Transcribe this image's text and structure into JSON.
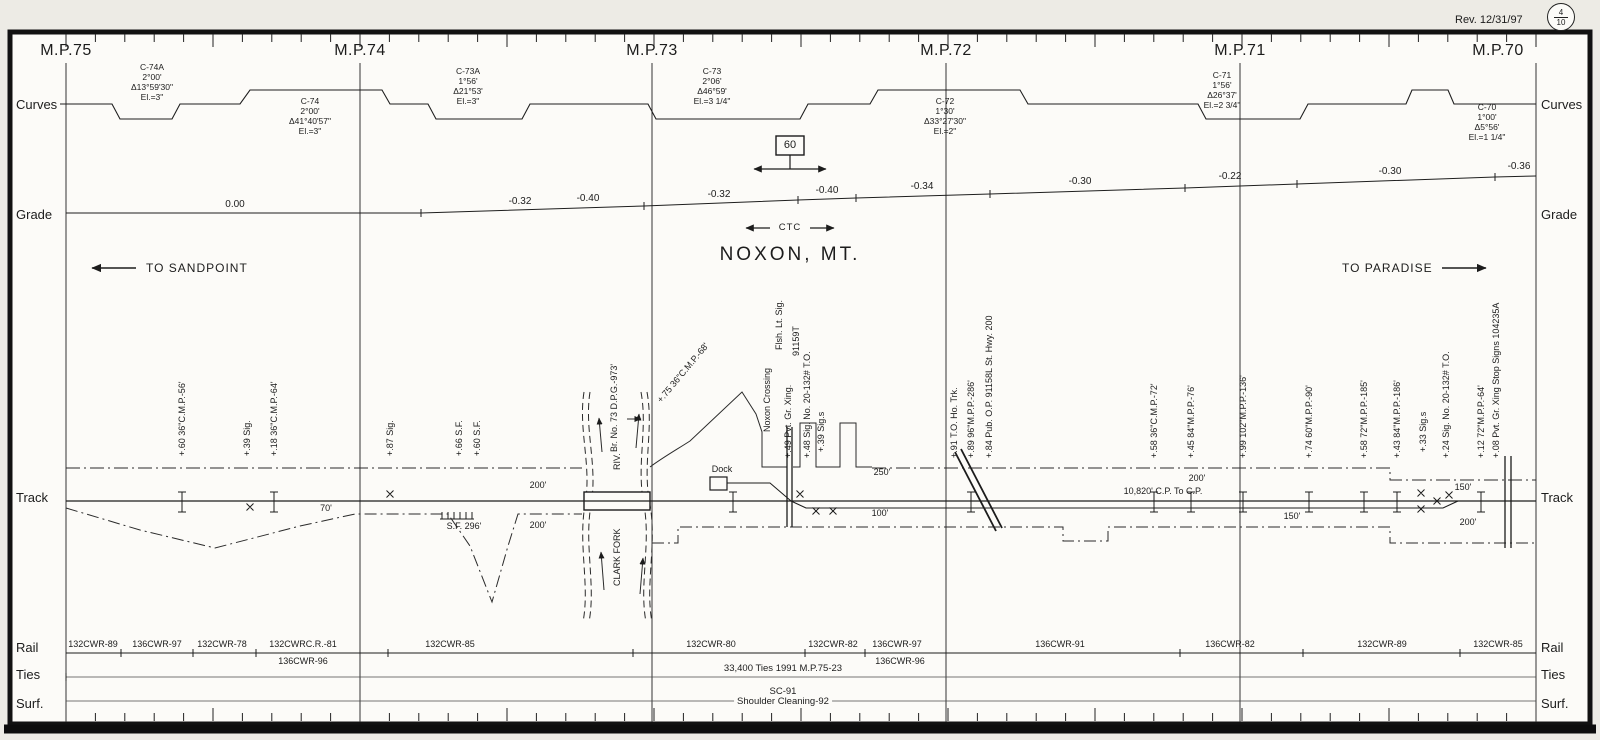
{
  "meta": {
    "rev": "Rev. 12/31/97",
    "sheet_num": "4",
    "sheet_total": "10"
  },
  "title": {
    "station": "NOXON, MT.",
    "ctc": "CTC",
    "speed": "60",
    "to_left": "TO SANDPOINT",
    "to_right": "TO PARADISE"
  },
  "gutter": {
    "rows": [
      {
        "t": "Curves",
        "y": 97
      },
      {
        "t": "Grade",
        "y": 207
      },
      {
        "t": "Track",
        "y": 490
      },
      {
        "t": "Rail",
        "y": 640
      },
      {
        "t": "Ties",
        "y": 667
      },
      {
        "t": "Surf.",
        "y": 696
      }
    ]
  },
  "mileposts": [
    {
      "label": "M.P.75",
      "label_x": 66,
      "line_x": 66
    },
    {
      "label": "M.P.74",
      "label_x": 360,
      "line_x": 360
    },
    {
      "label": "M.P.73",
      "label_x": 652,
      "line_x": 652
    },
    {
      "label": "M.P.72",
      "label_x": 946,
      "line_x": 946
    },
    {
      "label": "M.P.71",
      "label_x": 1240,
      "line_x": 1240
    },
    {
      "label": "M.P.70",
      "label_x": 1498,
      "line_x": 1536
    }
  ],
  "curves": [
    {
      "name": "C-74A",
      "deg": "2°00'",
      "delta": "Δ13°59'30\"",
      "el": "El.=3\"",
      "cx": 152,
      "top": 62
    },
    {
      "name": "C-74",
      "deg": "2°00'",
      "delta": "Δ41°40'57\"",
      "el": "El.=3\"",
      "cx": 310,
      "top": 96
    },
    {
      "name": "C-73A",
      "deg": "1°56'",
      "delta": "Δ21°53'",
      "el": "El.=3\"",
      "cx": 468,
      "top": 66
    },
    {
      "name": "C-73",
      "deg": "2°06'",
      "delta": "Δ46°59'",
      "el": "El.=3 1/4\"",
      "cx": 712,
      "top": 66
    },
    {
      "name": "C-72",
      "deg": "1°30'",
      "delta": "Δ33°27'30\"",
      "el": "El.=2\"",
      "cx": 945,
      "top": 96
    },
    {
      "name": "C-71",
      "deg": "1°56'",
      "delta": "Δ26°37'",
      "el": "El.=2 3/4\"",
      "cx": 1222,
      "top": 70
    },
    {
      "name": "C-70",
      "deg": "1°00'",
      "delta": "Δ5°56'",
      "el": "El.=1 1/4\"",
      "cx": 1487,
      "top": 102
    }
  ],
  "grade": {
    "values": [
      {
        "v": "0.00",
        "x": 235,
        "y": 199
      },
      {
        "v": "-0.32",
        "x": 520,
        "y": 196
      },
      {
        "v": "-0.40",
        "x": 588,
        "y": 193
      },
      {
        "v": "-0.32",
        "x": 719,
        "y": 189
      },
      {
        "v": "-0.40",
        "x": 827,
        "y": 185
      },
      {
        "v": "-0.34",
        "x": 922,
        "y": 181
      },
      {
        "v": "-0.30",
        "x": 1080,
        "y": 176
      },
      {
        "v": "-0.22",
        "x": 1230,
        "y": 171
      },
      {
        "v": "-0.30",
        "x": 1390,
        "y": 166
      },
      {
        "v": "-0.36",
        "x": 1519,
        "y": 161
      }
    ],
    "ticks": [
      [
        421,
        213
      ],
      [
        644,
        206
      ],
      [
        798,
        200
      ],
      [
        856,
        198
      ],
      [
        990,
        194
      ],
      [
        1185,
        188
      ],
      [
        1297,
        184
      ],
      [
        1495,
        177
      ]
    ]
  },
  "track": {
    "dock_label": "Dock",
    "vlabels": [
      {
        "t": "+.60 36\"C.M.P.-56'",
        "x": 182,
        "b": 456
      },
      {
        "t": "+.39 Sig.",
        "x": 247,
        "b": 456
      },
      {
        "t": "+.18 36\"C.M.P.-64'",
        "x": 274,
        "b": 456
      },
      {
        "t": "+.87 Sig.",
        "x": 390,
        "b": 456
      },
      {
        "t": "+.66 S.F.",
        "x": 459,
        "b": 456
      },
      {
        "t": "+.60 S.F.",
        "x": 477,
        "b": 456
      },
      {
        "t": "Br. No. 73  D.P.G.-973'",
        "x": 614,
        "b": 452
      },
      {
        "t": "+.75 36\"C.M.P.-68'",
        "x": 660,
        "b": 398,
        "rot": -50
      },
      {
        "t": "Noxon Crossing",
        "x": 767,
        "b": 432
      },
      {
        "t": "Flsh. Lt. Sig.",
        "x": 779,
        "b": 350
      },
      {
        "t": "+.49 Pvt. Gr. Xing.",
        "x": 788,
        "b": 458
      },
      {
        "t": "91159T",
        "x": 796,
        "b": 356
      },
      {
        "t": "+.48 Sig. No. 20-132# T.O.",
        "x": 807,
        "b": 458
      },
      {
        "t": "+.39 Sig.s",
        "x": 821,
        "b": 452
      },
      {
        "t": "+.91 T.O. Ho. Trk.",
        "x": 954,
        "b": 458
      },
      {
        "t": "+.89 96\"M.P.P.-286'",
        "x": 971,
        "b": 458
      },
      {
        "t": "+.84 Pub. O.P. 91158L St. Hwy. 200",
        "x": 989,
        "b": 458
      },
      {
        "t": "+.58 36\"C.M.P.-72'",
        "x": 1154,
        "b": 458
      },
      {
        "t": "+.45 84\"M.P.P.-76'",
        "x": 1191,
        "b": 458
      },
      {
        "t": "+.99 102\"M.P.P.-136'",
        "x": 1243,
        "b": 458
      },
      {
        "t": "+.74 60\"M.P.P.-90'",
        "x": 1309,
        "b": 458
      },
      {
        "t": "+.58 72\"M.P.P.-185'",
        "x": 1364,
        "b": 458
      },
      {
        "t": "+.43 84\"M.P.P.-186'",
        "x": 1397,
        "b": 458
      },
      {
        "t": "+.33 Sig.s",
        "x": 1423,
        "b": 452
      },
      {
        "t": "+.24 Sig. No. 20-132# T.O.",
        "x": 1446,
        "b": 458
      },
      {
        "t": "+.12 72\"M.P.P.-64'",
        "x": 1481,
        "b": 458
      },
      {
        "t": "+.08 Pvt. Gr. Xing Stop Signs 104235A",
        "x": 1496,
        "b": 458
      },
      {
        "t": "RIV.",
        "x": 617,
        "b": 470
      },
      {
        "t": "CLARK FORK",
        "x": 617,
        "b": 586
      }
    ],
    "distances": [
      {
        "t": "70'",
        "x": 326,
        "y": 503
      },
      {
        "t": "200'",
        "x": 538,
        "y": 480
      },
      {
        "t": "200'",
        "x": 538,
        "y": 520
      },
      {
        "t": "S.F. 296'",
        "x": 464,
        "y": 521
      },
      {
        "t": "250'",
        "x": 882,
        "y": 467
      },
      {
        "t": "100'",
        "x": 880,
        "y": 508
      },
      {
        "t": "200'",
        "x": 1197,
        "y": 473
      },
      {
        "t": "10,820' C.P. To C.P.",
        "x": 1163,
        "y": 486
      },
      {
        "t": "150'",
        "x": 1292,
        "y": 511
      },
      {
        "t": "150'",
        "x": 1463,
        "y": 482
      },
      {
        "t": "200'",
        "x": 1468,
        "y": 517
      }
    ],
    "culvert_x": [
      182,
      274,
      733,
      971,
      1154,
      1191,
      1243,
      1309,
      1364,
      1397,
      1481
    ],
    "x_marks": [
      [
        250,
        507
      ],
      [
        390,
        494
      ],
      [
        800,
        494
      ],
      [
        816,
        511
      ],
      [
        833,
        511
      ],
      [
        1421,
        493
      ],
      [
        1421,
        509
      ],
      [
        1437,
        501
      ],
      [
        1449,
        495
      ]
    ]
  },
  "rail": {
    "above": [
      {
        "t": "132CWR-89",
        "x": 93
      },
      {
        "t": "136CWR-97",
        "x": 157
      },
      {
        "t": "132CWR-78",
        "x": 222
      },
      {
        "t": "132CWRC.R.-81",
        "x": 303
      },
      {
        "t": "132CWR-85",
        "x": 450
      },
      {
        "t": "132CWR-80",
        "x": 711
      },
      {
        "t": "132CWR-82",
        "x": 833
      },
      {
        "t": "136CWR-97",
        "x": 897
      },
      {
        "t": "136CWR-91",
        "x": 1060
      },
      {
        "t": "136CWR-82",
        "x": 1230
      },
      {
        "t": "132CWR-89",
        "x": 1382
      },
      {
        "t": "132CWR-85",
        "x": 1498
      }
    ],
    "below": [
      {
        "t": "136CWR-96",
        "x": 303
      },
      {
        "t": "136CWR-96",
        "x": 900
      }
    ],
    "tick_x": [
      121,
      193,
      256,
      388,
      633,
      805,
      865,
      1180,
      1303,
      1460
    ]
  },
  "ties": {
    "note": "33,400 Ties 1991 M.P.75-23"
  },
  "surf": {
    "line1": "SC-91",
    "line2": "Shoulder Cleaning-92"
  }
}
